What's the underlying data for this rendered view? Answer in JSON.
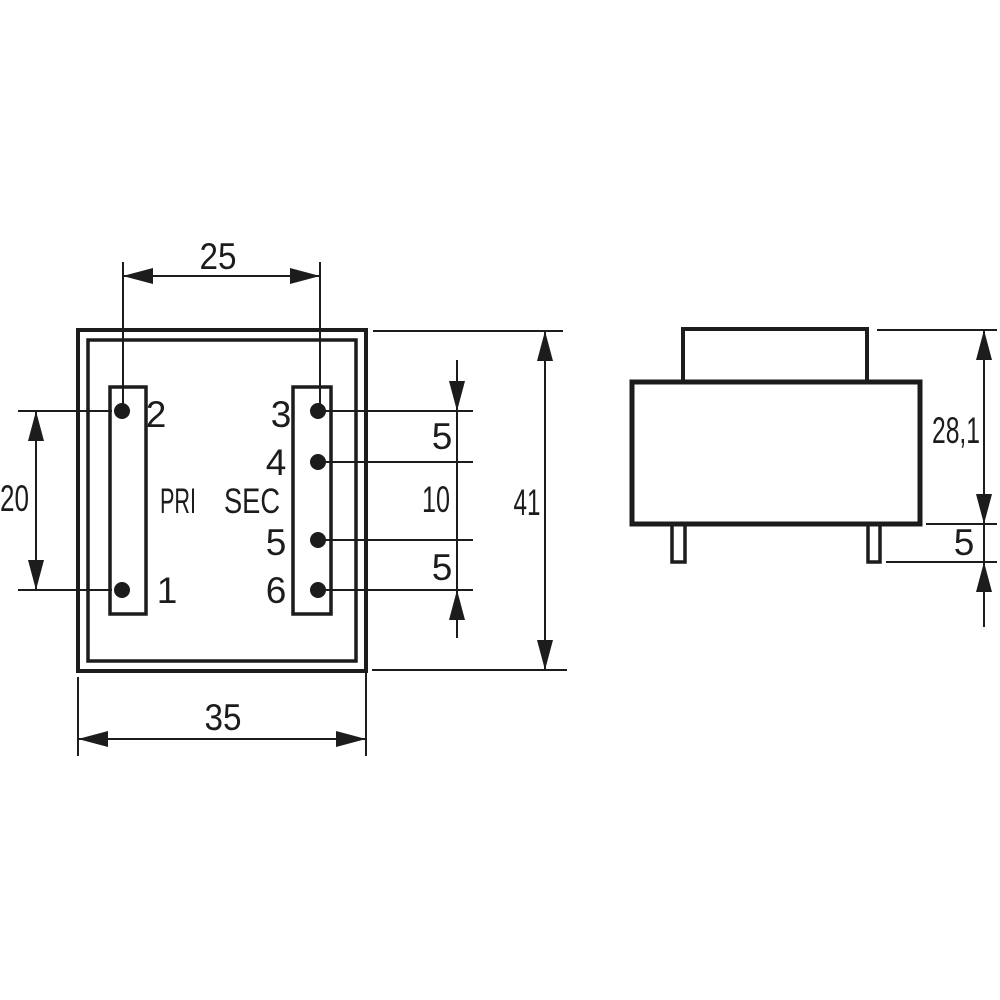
{
  "top_view": {
    "pri_label": "PRI",
    "sec_label": "SEC",
    "pin_labels": {
      "pin1": "1",
      "pin2": "2",
      "pin3": "3",
      "pin4": "4",
      "pin5": "5",
      "pin6": "6"
    },
    "dimensions": {
      "pin_column_pitch": "25",
      "pri_pin_spacing": "20",
      "sec_pin_spacing_top": "5",
      "sec_pin_spacing_middle": "10",
      "sec_pin_spacing_bottom": "5",
      "case_length": "41",
      "case_width": "35"
    }
  },
  "side_view": {
    "dimensions": {
      "body_height": "28,1",
      "pin_length": "5"
    }
  },
  "colors": {
    "ink": "#1c1c1c",
    "background": "#ffffff"
  }
}
